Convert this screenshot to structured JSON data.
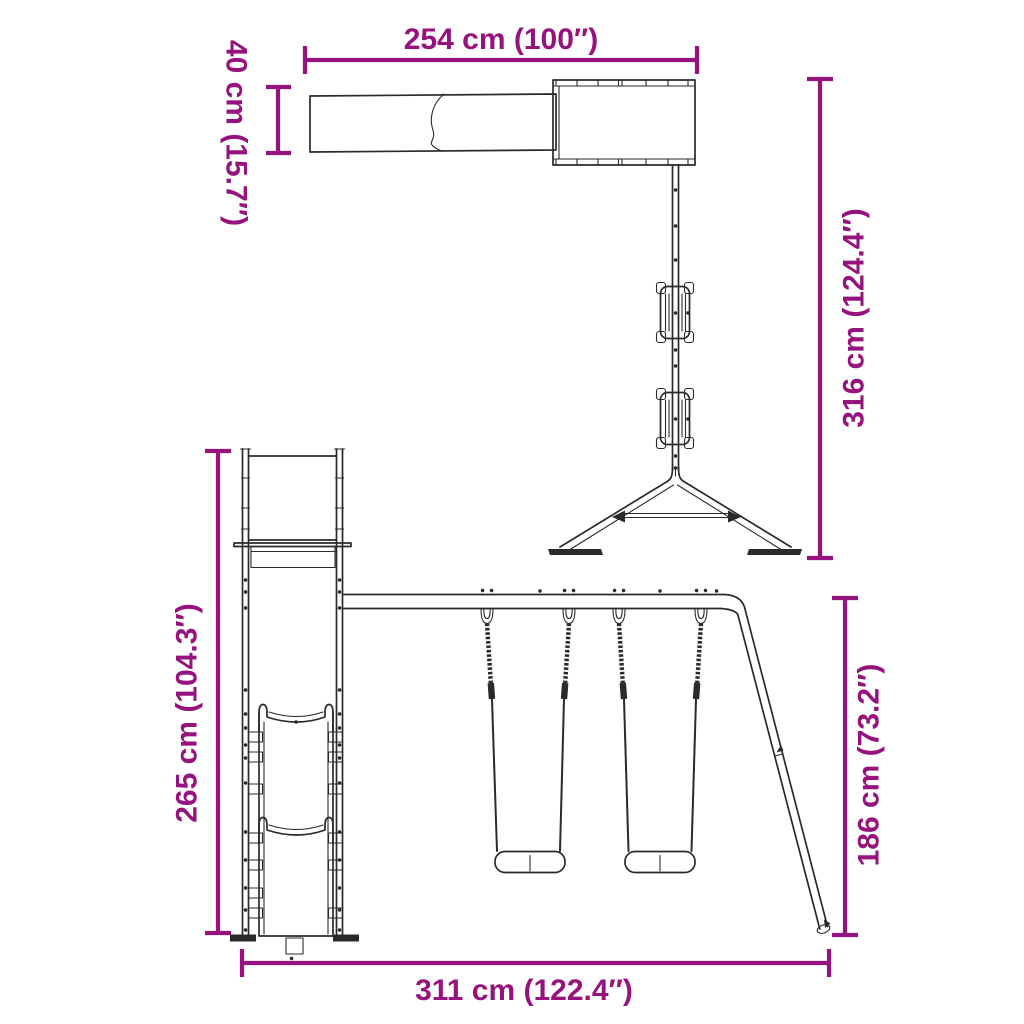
{
  "colors": {
    "dimension": "#96137e",
    "line": "#2a2a28",
    "background": "#ffffff"
  },
  "views": {
    "top_view": {
      "dimensions": {
        "beam_length": {
          "label": "254 cm (100″)",
          "cm": 254,
          "inches": 100
        },
        "slide_width": {
          "label": "40 cm (15.7″)",
          "cm": 40,
          "inches": 15.7
        },
        "overall_depth": {
          "label": "316 cm (124.4″)",
          "cm": 316,
          "inches": 124.4
        }
      }
    },
    "front_view": {
      "dimensions": {
        "tower_height": {
          "label": "265 cm (104.3″)",
          "cm": 265,
          "inches": 104.3
        },
        "swing_frame_height": {
          "label": "186 cm (73.2″)",
          "cm": 186,
          "inches": 73.2
        },
        "overall_width": {
          "label": "311 cm (122.4″)",
          "cm": 311,
          "inches": 122.4
        }
      }
    }
  }
}
